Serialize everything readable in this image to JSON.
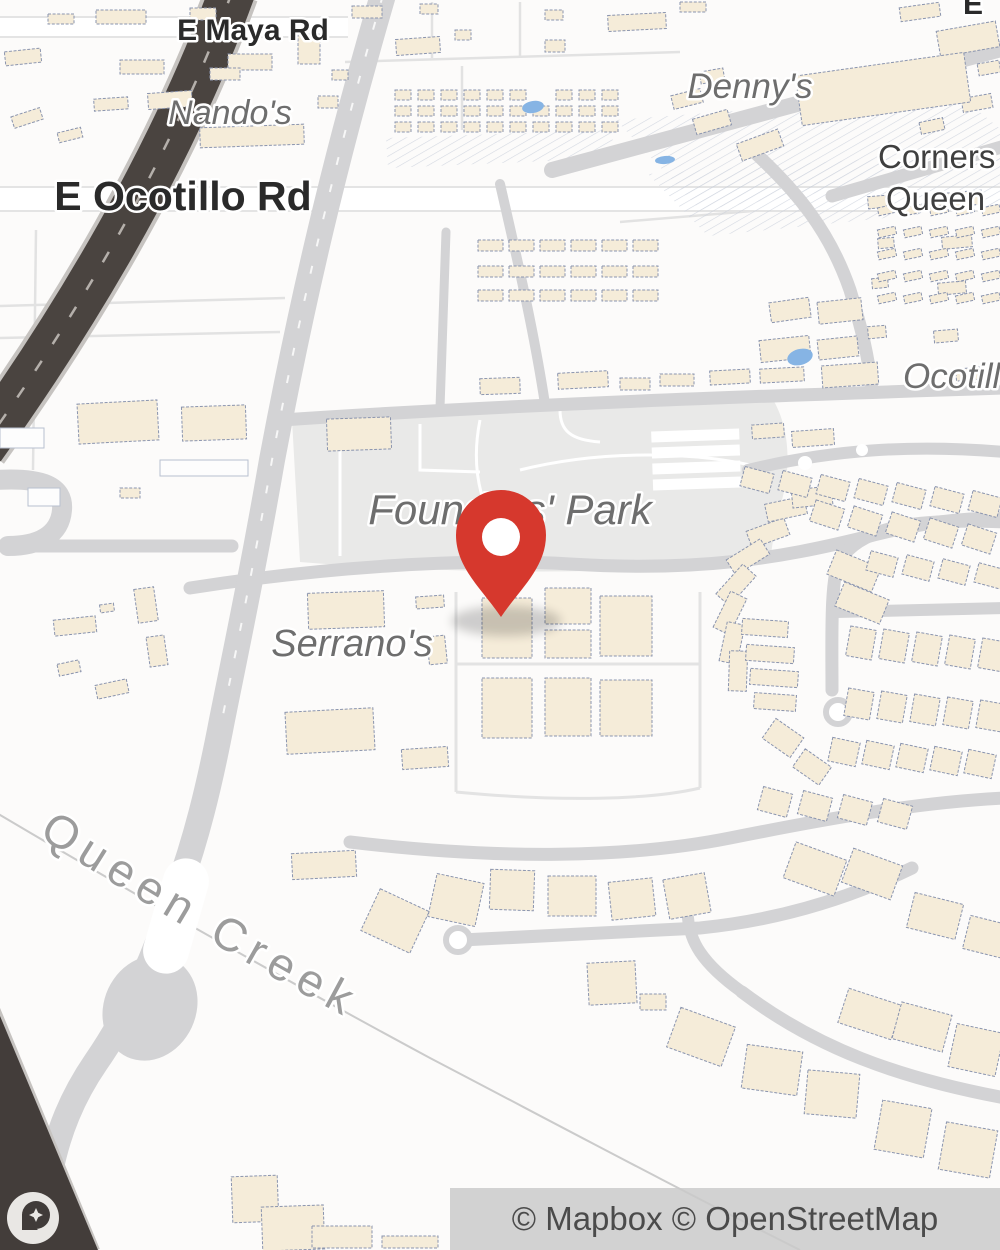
{
  "map": {
    "labels": {
      "maya_rd": "E Maya Rd",
      "ocotillo_rd": "E Ocotillo Rd",
      "nandos": "Nando's",
      "dennys": "Denny's",
      "corners": "Corners",
      "queen": "Queen",
      "ocotillo_right": "Ocotillo",
      "e_partial": "E",
      "founders_park": "Founders' Park",
      "serranos": "Serrano's",
      "queen_creek": "Queen Creek"
    },
    "attribution": "© Mapbox © OpenStreetMap",
    "marker": {
      "name": "location-pin"
    },
    "colors": {
      "bg": "#fcfbfa",
      "bldg": "#f5ecd9",
      "bldgStroke": "#8a94ae",
      "road": "#d3d3d5",
      "darkRoad": "#4a4440",
      "park": "#e9e9e8",
      "water": "#86b4e4",
      "pin": "#d6382d",
      "creek": "#cbcbcb"
    }
  }
}
